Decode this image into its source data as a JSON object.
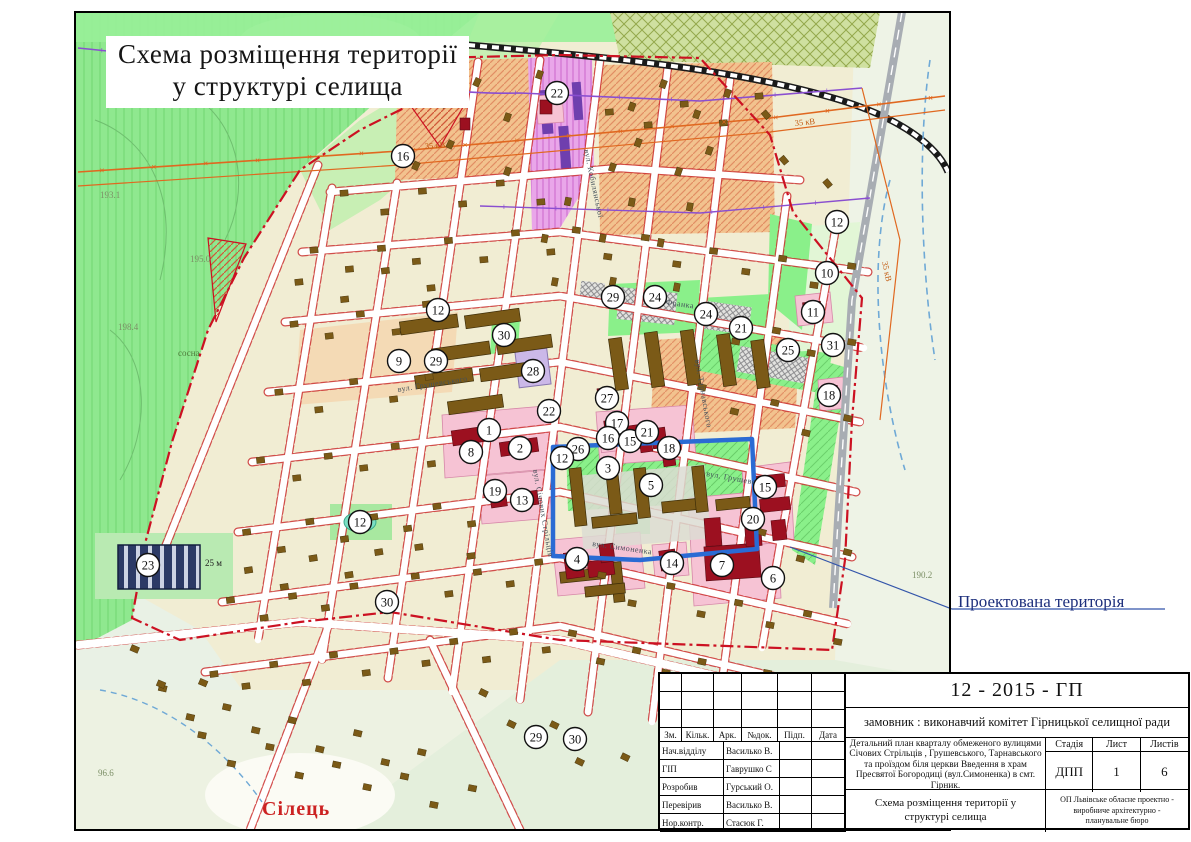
{
  "page": {
    "map_title_line1": "Схема розміщення території",
    "map_title_line2": "у структурі селища"
  },
  "map": {
    "annotations": {
      "projected_territory": "Проектована територія",
      "village": "Сілець",
      "block_width": "25 м",
      "pine": "сосна"
    },
    "power_labels": [
      {
        "text": "35 кВ",
        "x": 425,
        "y": 149,
        "rot": -4
      },
      {
        "text": "35 кВ",
        "x": 795,
        "y": 126,
        "rot": -6
      },
      {
        "text": "35 кВ",
        "x": 882,
        "y": 262,
        "rot": 78
      }
    ],
    "elevations": [
      {
        "text": "195.3",
        "x": 214,
        "y": 46
      },
      {
        "text": "193.1",
        "x": 100,
        "y": 198
      },
      {
        "text": "195.0",
        "x": 190,
        "y": 262
      },
      {
        "text": "198.4",
        "x": 118,
        "y": 330
      },
      {
        "text": "190.2",
        "x": 912,
        "y": 578
      },
      {
        "text": "96.6",
        "x": 98,
        "y": 776
      }
    ],
    "street_labels": [
      {
        "text": "вул. Грушевського",
        "x": 398,
        "y": 392,
        "rot": -9
      },
      {
        "text": "вул. Грушевського",
        "x": 706,
        "y": 476,
        "rot": 10
      },
      {
        "text": "вул. Франка",
        "x": 648,
        "y": 302,
        "rot": 8
      },
      {
        "text": "вул. Симоненка",
        "x": 592,
        "y": 546,
        "rot": 8
      },
      {
        "text": "вул. Кобилянської",
        "x": 584,
        "y": 150,
        "rot": 78
      },
      {
        "text": "вул. Тарнавського",
        "x": 695,
        "y": 360,
        "rot": 80
      },
      {
        "text": "вул. Січових Стрільців",
        "x": 533,
        "y": 470,
        "rot": 80
      }
    ],
    "markers": [
      {
        "n": "16",
        "x": 403,
        "y": 156
      },
      {
        "n": "22",
        "x": 557,
        "y": 93
      },
      {
        "n": "12",
        "x": 837,
        "y": 222
      },
      {
        "n": "10",
        "x": 827,
        "y": 273
      },
      {
        "n": "29",
        "x": 613,
        "y": 297
      },
      {
        "n": "24",
        "x": 655,
        "y": 297
      },
      {
        "n": "24",
        "x": 706,
        "y": 314
      },
      {
        "n": "21",
        "x": 741,
        "y": 328
      },
      {
        "n": "11",
        "x": 813,
        "y": 312
      },
      {
        "n": "25",
        "x": 788,
        "y": 350
      },
      {
        "n": "31",
        "x": 833,
        "y": 345
      },
      {
        "n": "12",
        "x": 438,
        "y": 310
      },
      {
        "n": "30",
        "x": 504,
        "y": 335
      },
      {
        "n": "28",
        "x": 533,
        "y": 371
      },
      {
        "n": "9",
        "x": 399,
        "y": 361
      },
      {
        "n": "29",
        "x": 436,
        "y": 361
      },
      {
        "n": "18",
        "x": 829,
        "y": 395
      },
      {
        "n": "27",
        "x": 607,
        "y": 398
      },
      {
        "n": "22",
        "x": 549,
        "y": 411
      },
      {
        "n": "17",
        "x": 617,
        "y": 423
      },
      {
        "n": "16",
        "x": 608,
        "y": 438
      },
      {
        "n": "15",
        "x": 630,
        "y": 441
      },
      {
        "n": "21",
        "x": 647,
        "y": 432
      },
      {
        "n": "18",
        "x": 669,
        "y": 448
      },
      {
        "n": "1",
        "x": 489,
        "y": 430
      },
      {
        "n": "2",
        "x": 520,
        "y": 448
      },
      {
        "n": "8",
        "x": 471,
        "y": 452
      },
      {
        "n": "26",
        "x": 578,
        "y": 449
      },
      {
        "n": "12",
        "x": 562,
        "y": 458
      },
      {
        "n": "3",
        "x": 608,
        "y": 468
      },
      {
        "n": "5",
        "x": 651,
        "y": 485
      },
      {
        "n": "19",
        "x": 495,
        "y": 491
      },
      {
        "n": "13",
        "x": 522,
        "y": 500
      },
      {
        "n": "15",
        "x": 765,
        "y": 487
      },
      {
        "n": "20",
        "x": 753,
        "y": 519
      },
      {
        "n": "12",
        "x": 360,
        "y": 522
      },
      {
        "n": "23",
        "x": 148,
        "y": 565
      },
      {
        "n": "4",
        "x": 577,
        "y": 559
      },
      {
        "n": "14",
        "x": 672,
        "y": 563
      },
      {
        "n": "7",
        "x": 722,
        "y": 565
      },
      {
        "n": "6",
        "x": 773,
        "y": 578
      },
      {
        "n": "30",
        "x": 387,
        "y": 602
      },
      {
        "n": "29",
        "x": 536,
        "y": 737
      },
      {
        "n": "30",
        "x": 575,
        "y": 739
      }
    ]
  },
  "title_block": {
    "project_code": "12 - 2015 - ГП",
    "client": "замовник : виконавчий комітет Гірницької селищної ради",
    "project_description": "Детальний план кварталу обмеженого вулицями Січових Стрільців , Грушевського, Тарнавського та проїздом біля церкви Введення в храм Пресвятої Богородиці (вул.Симоненка) в смт. Гірник.",
    "sheet_title": "Схема розміщення території у структурі селища",
    "organization": "ОП Львівське обласне проектно - виробниче архітектурно - планувальне бюро",
    "columns": [
      "Зм.",
      "Кільк.",
      "Арк.",
      "№док.",
      "Підп.",
      "Дата"
    ],
    "stage_label": "Стадія",
    "sheet_label": "Лист",
    "sheets_label": "Листів",
    "stage": "ДПП",
    "sheet": "1",
    "sheets": "6",
    "signatures": [
      {
        "role": "Нач.відділу",
        "name": "Василько В."
      },
      {
        "role": "ГІП",
        "name": "Гаврушко С"
      },
      {
        "role": "Розробив",
        "name": "Гурський О."
      },
      {
        "role": "Перевірив",
        "name": "Василько В."
      },
      {
        "role": "Нор.контр.",
        "name": "Стасюк Г."
      }
    ]
  },
  "colors": {
    "forest": "#8fe88f",
    "park": "#8af08a",
    "urban": "#f1edd3",
    "orange_block": "#f2c28e",
    "purple_block": "#e9a6e9",
    "pink_plot": "#f6c3d4",
    "building_red": "#9c1020",
    "house_brown": "#7b5a17",
    "navy_block": "#2c3a66",
    "boundary_red": "#cc1122",
    "project_blue": "#2a6bd4",
    "street_edge_red": "#cc3333",
    "rail": "#1a1a1a",
    "power_orange": "#e06820",
    "power_purple": "#8a4fd0",
    "water": "#6fa9d6"
  }
}
